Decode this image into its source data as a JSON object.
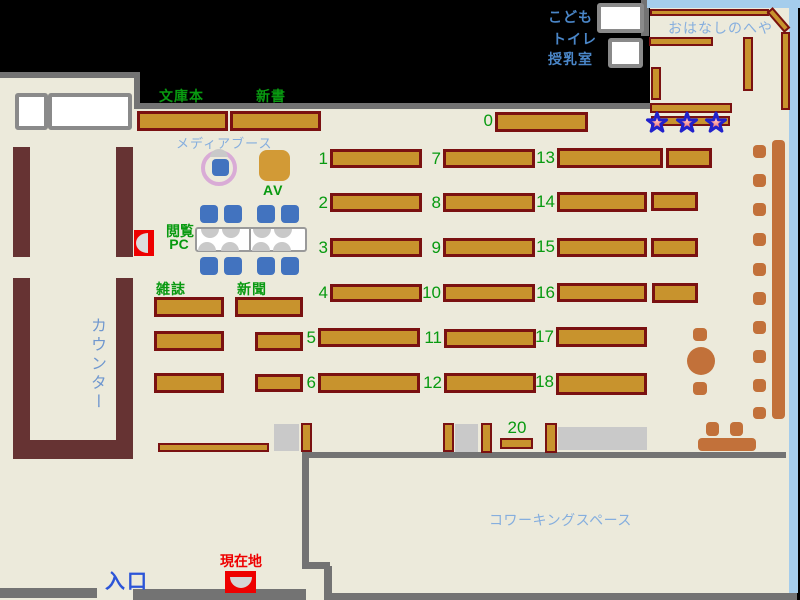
{
  "palette": {
    "floor": "#eceadb",
    "wall-gray": "#737373",
    "blue-wall": "#a5cdec",
    "shelf-fill": "#c8932d",
    "shelf-border": "#7a1111",
    "counter": "#663333",
    "sienna": "#c2713a",
    "chair-blue": "#4273bf",
    "gray-box": "#c9c9c9",
    "green-label": "#089a10",
    "light-blue-text": "#85aede",
    "mid-blue-text": "#4a86c8",
    "counter-text": "#6f97cf",
    "entrance-blue": "#2c55d8",
    "red": "#ee0000",
    "media-ring": "#d9abd6",
    "av-fill": "#d29a36",
    "star-stroke": "#2121cc"
  },
  "rooms": {
    "story_room": "おはなしのへや",
    "coworking": "コワーキングスペース"
  },
  "areas": {
    "kids": "こども",
    "toilet": "トイレ",
    "nursing": "授乳室",
    "counter": "カウンター",
    "entrance": "入口",
    "current_location": "現在地"
  },
  "sections": {
    "paperbacks": "文庫本",
    "new_books": "新書",
    "magazines": "雑誌",
    "newspapers": "新聞",
    "media_booth": "メディアブース",
    "av": "AV",
    "pc_line1": "閲覧",
    "pc_line2": "PC"
  },
  "shelf_labels": {
    "s0": "0",
    "s1": "1",
    "s2": "2",
    "s3": "3",
    "s4": "4",
    "s5": "5",
    "s6": "6",
    "s7": "7",
    "s8": "8",
    "s9": "9",
    "s10": "10",
    "s11": "11",
    "s12": "12",
    "s13": "13",
    "s14": "14",
    "s15": "15",
    "s16": "16",
    "s17": "17",
    "s18": "18",
    "s20": "20"
  }
}
